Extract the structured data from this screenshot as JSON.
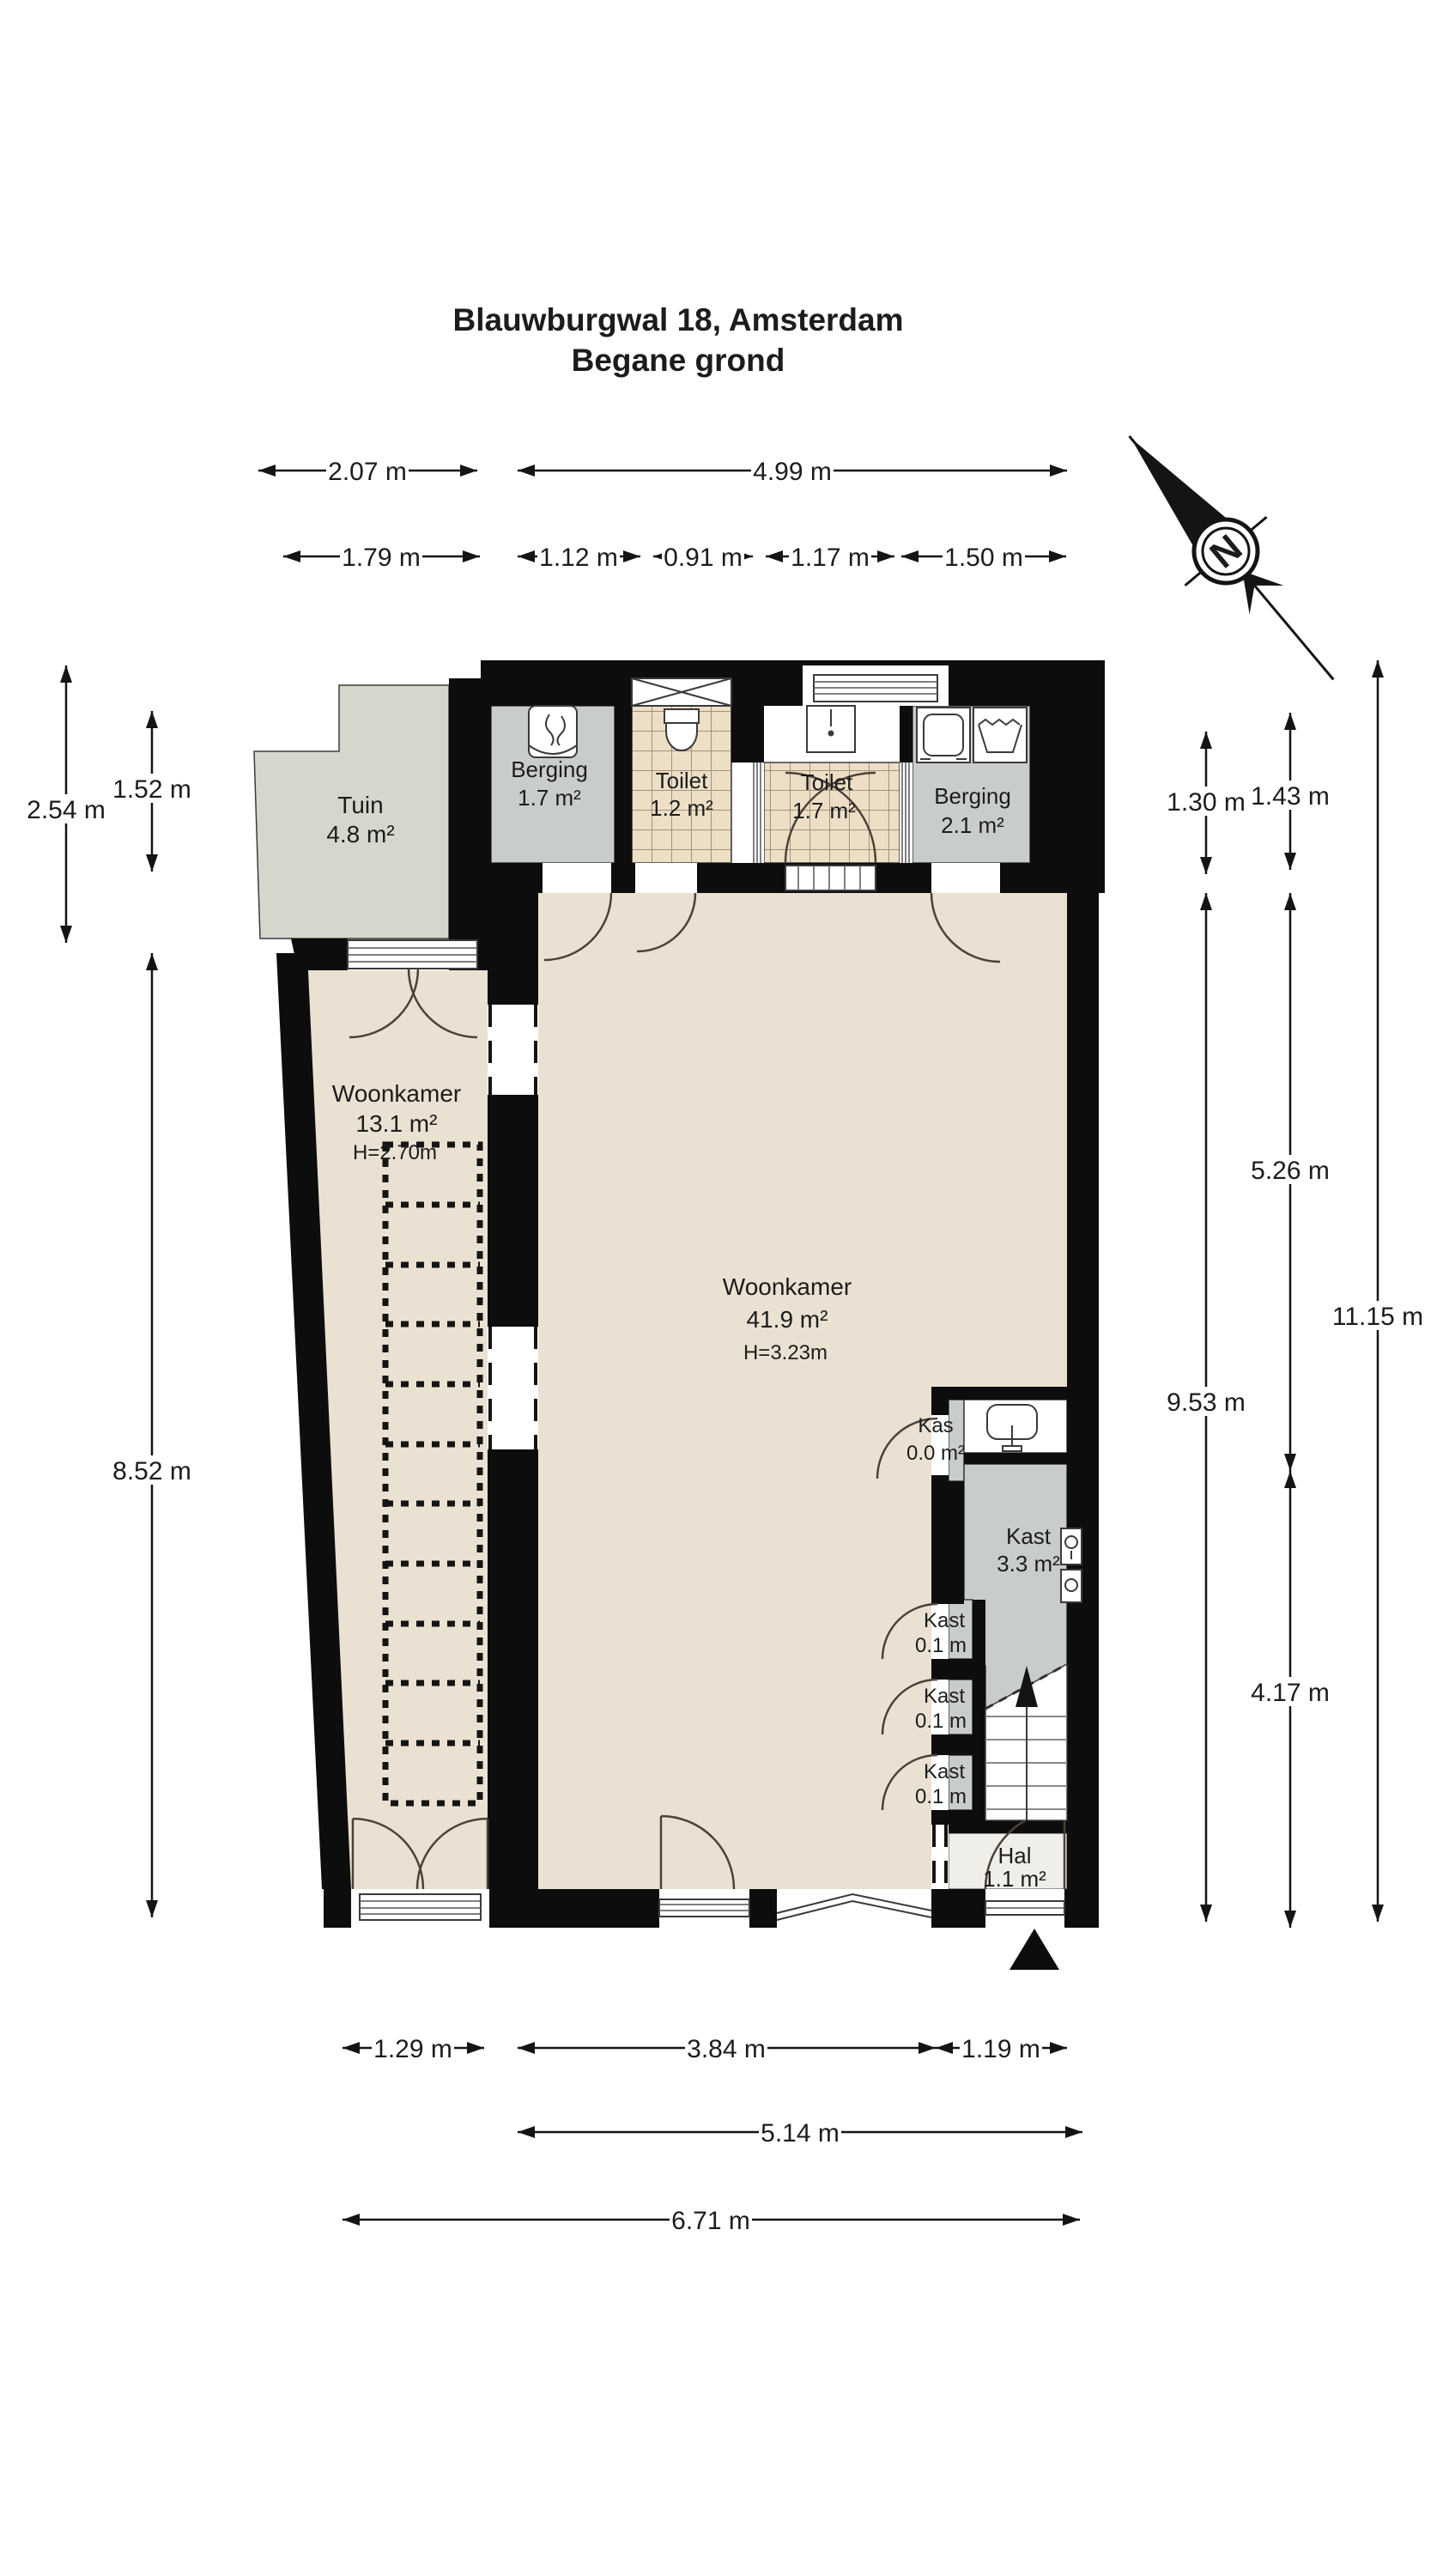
{
  "title": {
    "line1": "Blauwburgwal 18, Amsterdam",
    "line2": "Begane grond"
  },
  "compass": {
    "north_letter": "N"
  },
  "rooms": {
    "tuin": {
      "name": "Tuin",
      "area": "4.8 m²"
    },
    "berging_links": {
      "name": "Berging",
      "area": "1.7 m²"
    },
    "toilet_links": {
      "name": "Toilet",
      "area": "1.2 m²"
    },
    "toilet_rechts": {
      "name": "Toilet",
      "area": "1.7 m²"
    },
    "berging_rechts": {
      "name": "Berging",
      "area": "2.1 m²"
    },
    "woonkamer_smal": {
      "name": "Woonkamer",
      "area": "13.1 m²",
      "height": "H=2.70m"
    },
    "woonkamer": {
      "name": "Woonkamer",
      "area": "41.9 m²",
      "height": "H=3.23m"
    },
    "kas": {
      "name": "Kas",
      "area": "0.0 m²"
    },
    "kast_groot": {
      "name": "Kast",
      "area": "3.3 m²"
    },
    "kast_1": {
      "name": "Kast",
      "area": "0.1 m"
    },
    "kast_2": {
      "name": "Kast",
      "area": "0.1 m"
    },
    "kast_3": {
      "name": "Kast",
      "area": "0.1 m"
    },
    "hal": {
      "name": "Hal",
      "area": "1.1 m²"
    }
  },
  "dimensions": {
    "top": {
      "w_tuin": "2.07 m",
      "w_main": "4.99 m",
      "w_tuin2": "1.79 m",
      "w_berging_l": "1.12 m",
      "w_toilet_l": "0.91 m",
      "w_toilet_r": "1.17 m",
      "w_berging_r": "1.50 m"
    },
    "left": {
      "h_tuin": "2.54 m",
      "h_tuin2": "1.52 m",
      "h_woonkamer_smal": "8.52 m"
    },
    "right": {
      "h_berging": "1.30 m",
      "h_toilet": "1.43 m",
      "h_boven": "5.26 m",
      "h_totaal": "11.15 m",
      "h_woonkamer": "9.53 m",
      "h_onder": "4.17 m"
    },
    "bottom": {
      "w_links": "1.29 m",
      "w_midden": "3.84 m",
      "w_hal": "1.19 m",
      "w_midden_totaal": "5.14 m",
      "w_totaal": "6.71 m"
    }
  },
  "colors": {
    "wall": "#0d0d0d",
    "floor": "#eae1d2",
    "garden": "#d6d6cd",
    "storage": "#c9cdc9",
    "tilefloor": "#ecdfc6",
    "hal": "#efeee8"
  }
}
